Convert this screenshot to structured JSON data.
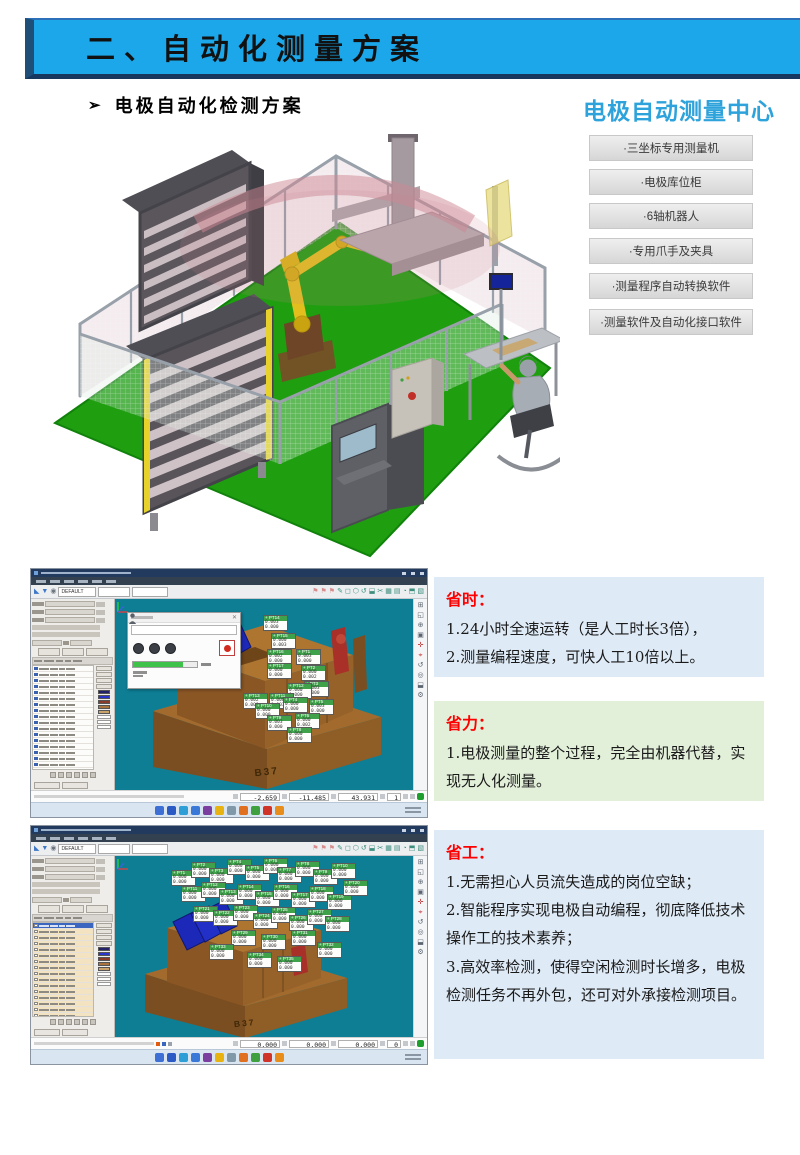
{
  "page": {
    "width": 800,
    "height": 1155,
    "bg": "#FFFFFF"
  },
  "banner": {
    "title": "二、自动化测量方案",
    "bg": "#1BA7E9",
    "border_color": "#2B70B8",
    "edge_color": "#1F4E79"
  },
  "section_heading": {
    "bullet": "➢",
    "text": "电极自动化检测方案"
  },
  "center_panel": {
    "title": "电极自动测量中心",
    "title_color": "#2EA3DB",
    "items": [
      "·三坐标专用测量机",
      "·电极库位柜",
      "·6轴机器人",
      "·专用爪手及夹具",
      "·测量程序自动转换软件",
      "·测量软件及自动化接口软件"
    ]
  },
  "scene": {
    "floor_color": "#1F9E10",
    "robot_color": "#E2BF1C",
    "fence_color": "#9AA2AC",
    "cabinet_color": "#55555A",
    "shelf_color": "#CFC2C6",
    "safety_zone_color": "#C88C96"
  },
  "shot_common": {
    "probe_value": "DEFAULT",
    "flag_default": "0.000",
    "toolbar_left_icons": [
      {
        "g": "◣",
        "c": "#3C78C8"
      },
      {
        "g": "▼",
        "c": "#3C78C8"
      },
      {
        "g": "◉",
        "c": "#6E7680"
      }
    ],
    "toolbar_right_icons": [
      {
        "g": "⚑",
        "c": "#D98C8C"
      },
      {
        "g": "⚑",
        "c": "#D98C8C"
      },
      {
        "g": "⚑",
        "c": "#D98C8C"
      },
      {
        "g": "✎",
        "c": "#3E8E7E"
      },
      {
        "g": "◻",
        "c": "#3E8E7E"
      },
      {
        "g": "⬡",
        "c": "#3E8E7E"
      },
      {
        "g": "↺",
        "c": "#3E8E7E"
      },
      {
        "g": "⬓",
        "c": "#3E8E7E"
      },
      {
        "g": "✂",
        "c": "#3E8E7E"
      },
      {
        "g": "▦",
        "c": "#3E8E7E"
      },
      {
        "g": "▤",
        "c": "#3E8E7E"
      },
      {
        "g": "◔",
        "c": "#3E8E7E"
      },
      {
        "g": "⬒",
        "c": "#3E8E7E"
      },
      {
        "g": "▧",
        "c": "#3E8E7E"
      }
    ],
    "right_tool_icons": [
      {
        "g": "⊞",
        "c": "#5A6470"
      },
      {
        "g": "◱",
        "c": "#5A6470"
      },
      {
        "g": "⊕",
        "c": "#5A6470"
      },
      {
        "g": "▣",
        "c": "#5A6470"
      },
      {
        "g": "✛",
        "c": "#C23030"
      },
      {
        "g": "⌖",
        "c": "#C23030"
      },
      {
        "g": "↺",
        "c": "#5A6470"
      },
      {
        "g": "◎",
        "c": "#5A6470"
      },
      {
        "g": "⬓",
        "c": "#5A6470"
      },
      {
        "g": "⚙",
        "c": "#5A6470"
      }
    ],
    "taskbar_colors": [
      "#3D6FD4",
      "#2B5AC4",
      "#2E9ED6",
      "#3A78D8",
      "#7B3FA0",
      "#E8B310",
      "#8098A8",
      "#E07020",
      "#3FA040",
      "#D03428",
      "#E88C1A"
    ],
    "swatches": [
      "#23226B",
      "#2B35CE",
      "#8A3A26",
      "#A8743C",
      "#C9A36B"
    ]
  },
  "screenshot1": {
    "viewport_label": "B37",
    "viewport_bg": "#0E7E95",
    "coords": {
      "x": "-2.659",
      "y": "-11.485",
      "z": "43.931",
      "count": "1"
    },
    "table_row_count": 20,
    "flags": [
      [
        148,
        16,
        "+ PT14",
        "0.003",
        "0.000"
      ],
      [
        156,
        34,
        "+ PT15",
        "0.000",
        "0.003"
      ],
      [
        152,
        50,
        "+ PT16",
        "0.002",
        "0.000"
      ],
      [
        181,
        50,
        "+ PT1",
        "0.003",
        "0.000"
      ],
      [
        186,
        66,
        "+ PT2",
        "0.000",
        "0.002"
      ],
      [
        152,
        64,
        "+ PT17",
        "0.000",
        "0.000"
      ],
      [
        189,
        82,
        "+ PT3",
        "0.003",
        "0.000"
      ],
      [
        172,
        84,
        "+ PT12",
        "0.000",
        "0.000"
      ],
      [
        128,
        94,
        "+ PT13",
        "0.002",
        "0.000"
      ],
      [
        154,
        94,
        "+ PT11",
        "0.000",
        "0.003"
      ],
      [
        168,
        98,
        "+ PT4",
        "0.000",
        "0.000"
      ],
      [
        194,
        100,
        "+ PT5",
        "0.003",
        "0.000"
      ],
      [
        140,
        104,
        "+ PT10",
        "0.000",
        "0.000"
      ],
      [
        180,
        114,
        "+ PT6",
        "0.000",
        "0.002"
      ],
      [
        152,
        116,
        "+ PT9",
        "0.003",
        "0.000"
      ],
      [
        172,
        128,
        "+ PT8",
        "0.000",
        "0.000"
      ]
    ]
  },
  "screenshot2": {
    "viewport_label": "B37",
    "viewport_bg": "#0E7E95",
    "coords": {
      "x": "0.000",
      "y": "0.000",
      "z": "0.000",
      "count": "0"
    },
    "table_row_count": 22,
    "flags": [
      [
        56,
        14,
        "+ PT1"
      ],
      [
        76,
        6,
        "+ PT2"
      ],
      [
        94,
        12,
        "+ PT3"
      ],
      [
        112,
        3,
        "+ PT4"
      ],
      [
        130,
        9,
        "+ PT5"
      ],
      [
        148,
        2,
        "+ PT6"
      ],
      [
        162,
        11,
        "+ PT7"
      ],
      [
        180,
        5,
        "+ PT8"
      ],
      [
        198,
        13,
        "+ PT9"
      ],
      [
        216,
        7,
        "+ PT10"
      ],
      [
        66,
        30,
        "+ PT11"
      ],
      [
        86,
        26,
        "+ PT12"
      ],
      [
        104,
        33,
        "+ PT13"
      ],
      [
        122,
        28,
        "+ PT14"
      ],
      [
        140,
        35,
        "+ PT15"
      ],
      [
        158,
        28,
        "+ PT16"
      ],
      [
        176,
        36,
        "+ PT17"
      ],
      [
        194,
        30,
        "+ PT18"
      ],
      [
        212,
        38,
        "+ PT19"
      ],
      [
        228,
        24,
        "+ PT20"
      ],
      [
        78,
        50,
        "+ PT21"
      ],
      [
        98,
        54,
        "+ PT22"
      ],
      [
        118,
        49,
        "+ PT23"
      ],
      [
        138,
        57,
        "+ PT24"
      ],
      [
        156,
        51,
        "+ PT25"
      ],
      [
        174,
        59,
        "+ PT26"
      ],
      [
        192,
        53,
        "+ PT27"
      ],
      [
        210,
        60,
        "+ PT28"
      ],
      [
        116,
        74,
        "+ PT29"
      ],
      [
        146,
        78,
        "+ PT30"
      ],
      [
        176,
        74,
        "+ PT31"
      ],
      [
        202,
        86,
        "+ PT32"
      ],
      [
        94,
        88,
        "+ PT33"
      ],
      [
        132,
        96,
        "+ PT34"
      ],
      [
        162,
        100,
        "+ PT35"
      ]
    ]
  },
  "benefits": [
    {
      "title": "省时：",
      "bg": "#DEEAF6",
      "title_color": "#FF0000",
      "lines": [
        "1.24小时全速运转（是人工时长3倍），",
        "2.测量编程速度，可快人工10倍以上。"
      ]
    },
    {
      "title": "省力：",
      "bg": "#E2EFD9",
      "title_color": "#FF0000",
      "lines": [
        "1.电极测量的整个过程，完全由机器代替，实现无人化测量。"
      ]
    },
    {
      "title": "省工：",
      "bg": "#DEEAF6",
      "title_color": "#FF0000",
      "lines": [
        "1.无需担心人员流失造成的岗位空缺；",
        "2.智能程序实现电极自动编程，彻底降低技术操作工的技术素养；",
        "3.高效率检测，使得空闲检测时长增多，电极检测任务不再外包，还可对外承接检测项目。"
      ]
    }
  ]
}
